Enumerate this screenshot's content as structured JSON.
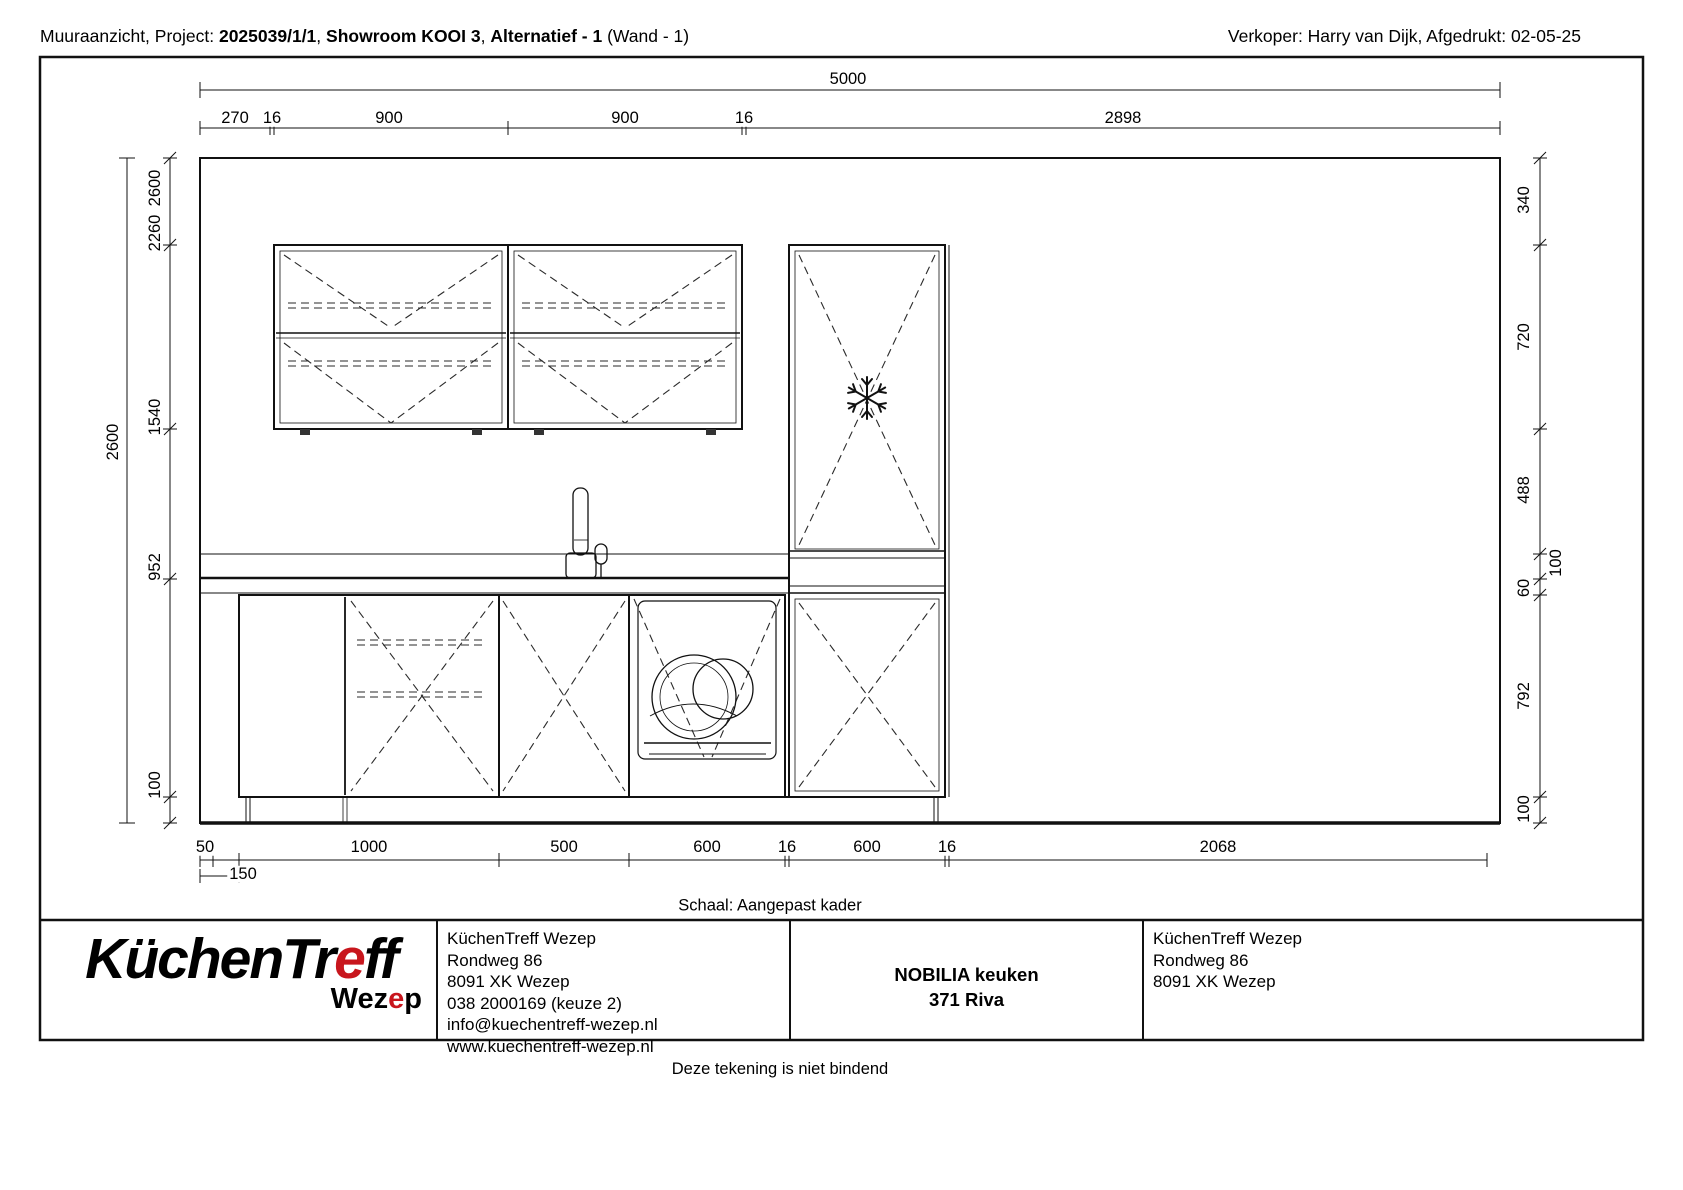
{
  "header": {
    "left_prefix": "Muuraanzicht, Project: ",
    "project_no": "2025039/1/1",
    "comma1": ", ",
    "project_name": "Showroom KOOI 3",
    "comma2": ", ",
    "alternative": "Alternatief - 1",
    "left_suffix": " (Wand - 1)",
    "right": "Verkoper: Harry van Dijk, Afgedrukt: 02-05-25"
  },
  "dims": {
    "top_total": "5000",
    "top_segments": [
      "270",
      "16",
      "900",
      "900",
      "16",
      "2898"
    ],
    "left_total": "2600",
    "left_chain": [
      "2600",
      "2260",
      "1540",
      "952",
      "100"
    ],
    "right_chain": [
      "340",
      "720",
      "488",
      "100",
      "60",
      "792",
      "100"
    ],
    "bottom_row1": [
      "50",
      "1000",
      "500",
      "600",
      "16",
      "600",
      "16",
      "2068"
    ],
    "bottom_row2": "150"
  },
  "notes": {
    "scale": "Schaal: Aangepast kader",
    "disclaimer": "Deze tekening is niet bindend"
  },
  "info_block": {
    "logo": {
      "main_pre": "KüchenTr",
      "main_accent": "e",
      "main_post": "ff",
      "sub_pre": "Wez",
      "sub_accent": "e",
      "sub_post": "p"
    },
    "dealer_full": [
      "KüchenTreff Wezep",
      "Rondweg 86",
      "8091 XK Wezep",
      "038 2000169 (keuze 2)",
      "info@kuechentreff-wezep.nl",
      "www.kuechentreff-wezep.nl"
    ],
    "product": {
      "brand_line": "NOBILIA keuken",
      "model_line": "371 Riva"
    },
    "dealer_short": [
      "KüchenTreff Wezep",
      "Rondweg 86",
      "8091 XK Wezep"
    ]
  },
  "colors": {
    "accent_red": "#c8161d",
    "line": "#111111"
  }
}
